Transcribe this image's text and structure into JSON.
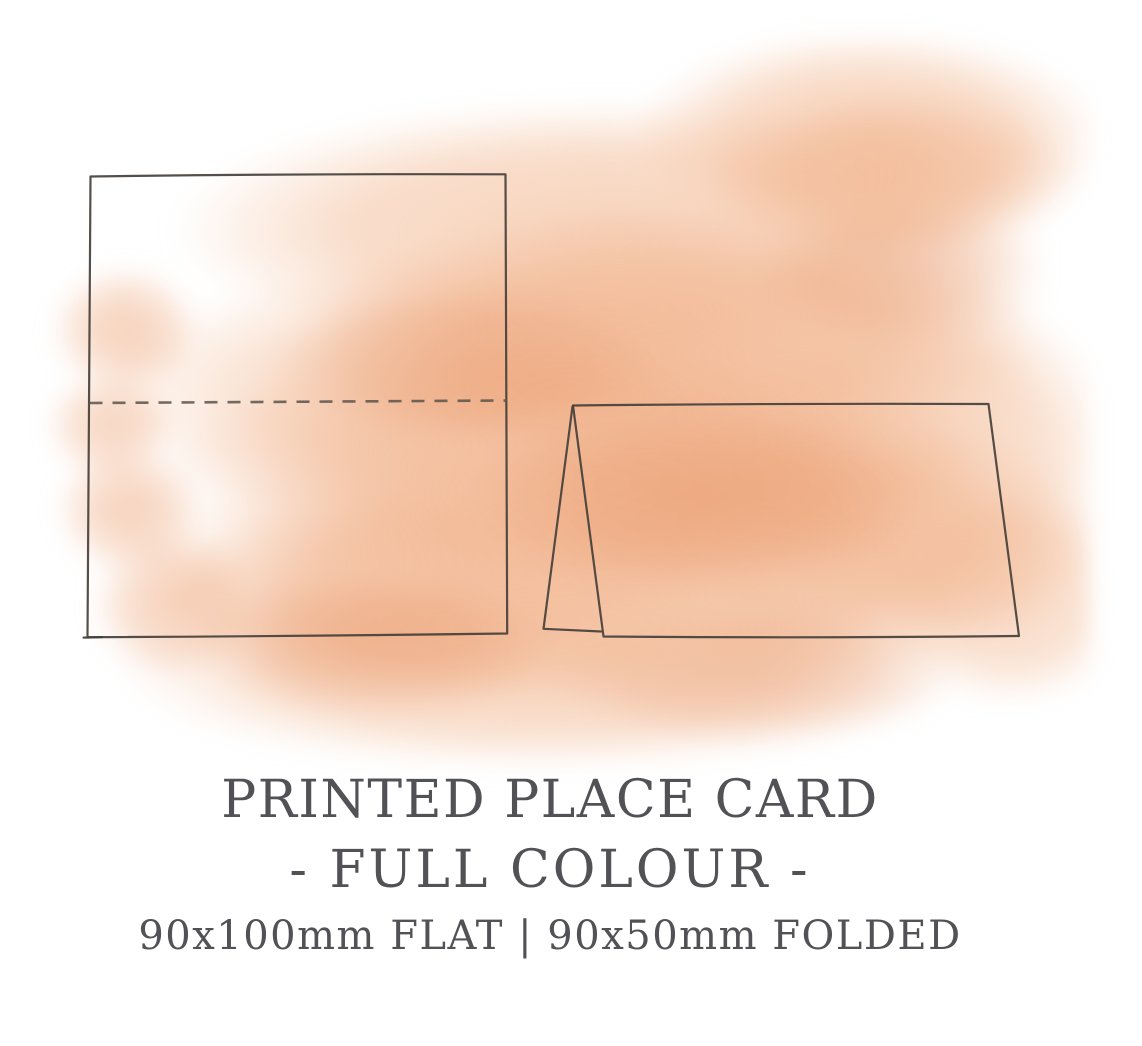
{
  "caption": {
    "title": "PRINTED PLACE CARD",
    "subtitle": "- FULL COLOUR -",
    "dimensions": "90x100mm FLAT | 90x50mm FOLDED"
  },
  "diagram": {
    "flat_card_label": "flat place card outline with dashed horizontal fold line",
    "folded_card_label": "folded tent place card outline with side fold triangle"
  },
  "colors": {
    "background": "#ffffff",
    "text": "#525256",
    "outline": "#45403b",
    "fold_dash": "#5a534b",
    "wash_light": "#f6ccb0",
    "wash_mid": "#f0ad84",
    "wash_deep": "#e89668"
  }
}
